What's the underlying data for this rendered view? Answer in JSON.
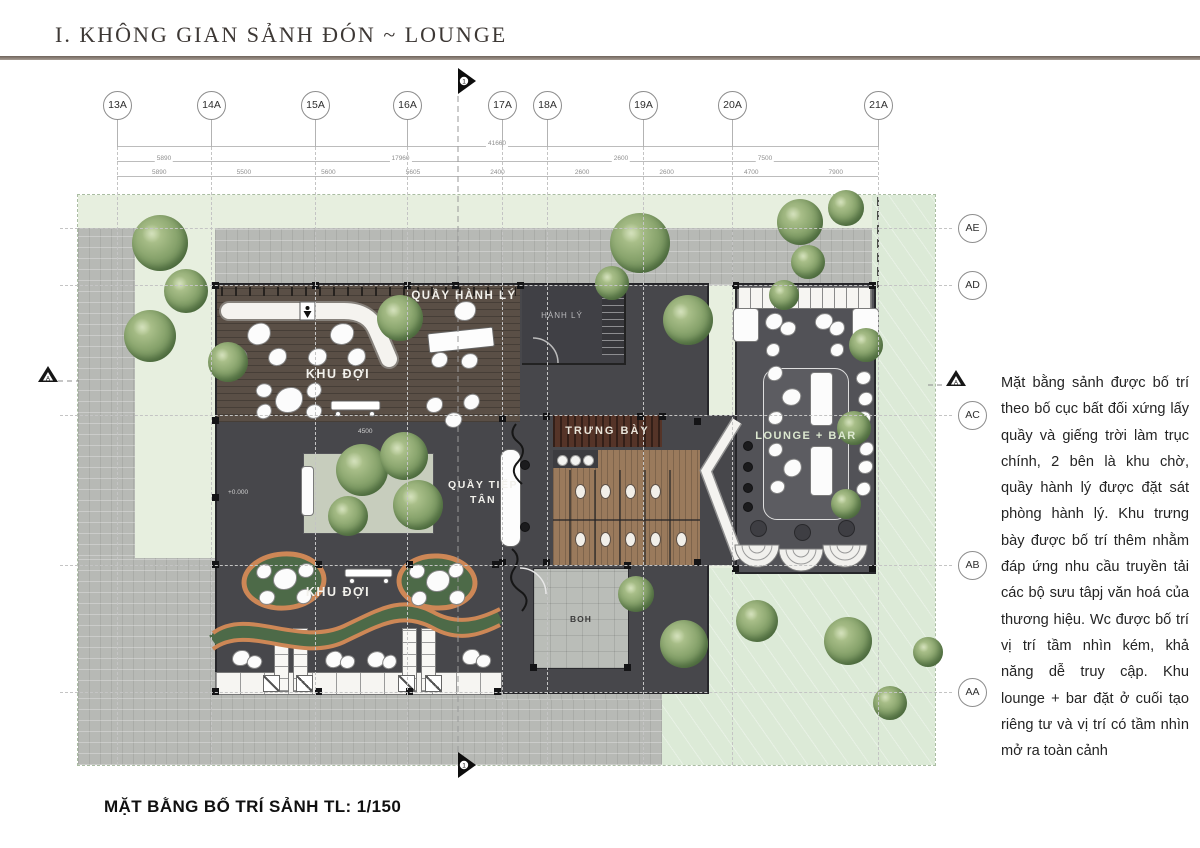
{
  "title": "I. KHÔNG GIAN SẢNH ĐÓN ~ LOUNGE",
  "caption": "MẶT BẰNG BỐ TRÍ SẢNH TL: 1/150",
  "annotation": "Mặt bằng sảnh được bố trí theo bố cục bất đối xứng lấy quầy và giếng trời làm trục chính, 2 bên là khu chờ, quầy hành lý được đặt sát phòng hành lý. Khu trưng bày được bố trí thêm nhằm đáp ứng nhu cầu truyền tải các bộ sưu tâpj văn hoá của thương hiệu. Wc được bố trí vị trí tầm nhìn kém, khả năng dễ truy cập. Khu lounge + bar đặt ở cuối tạo riêng tư và vị trí có tầm nhìn mở ra toàn cảnh",
  "labels": {
    "khu_doi_top": "KHU ĐỢI",
    "quay_hanh_ly": "QUẦY HÀNH LÝ",
    "hanh_ly": "HÀNH LÝ",
    "trung_bay": "TRƯNG BÀY",
    "quay_tiep_tan": "QUẦY TIẾP TÂN",
    "khu_doi_bottom": "KHU ĐỢI",
    "lounge_bar": "LOUNGE + BAR",
    "boh": "BOH"
  },
  "section_marker_label": "1",
  "elevation_marker_label": "A",
  "grid_top": [
    {
      "label": "13A",
      "x": 117
    },
    {
      "label": "14A",
      "x": 211
    },
    {
      "label": "15A",
      "x": 315
    },
    {
      "label": "16A",
      "x": 407
    },
    {
      "label": "17A",
      "x": 502
    },
    {
      "label": "18A",
      "x": 547
    },
    {
      "label": "19A",
      "x": 643
    },
    {
      "label": "20A",
      "x": 732
    },
    {
      "label": "21A",
      "x": 878
    }
  ],
  "grid_right": [
    {
      "label": "AE",
      "y": 228
    },
    {
      "label": "AD",
      "y": 285
    },
    {
      "label": "AC",
      "y": 415
    },
    {
      "label": "AB",
      "y": 565
    },
    {
      "label": "AA",
      "y": 692
    }
  ],
  "dimensions": {
    "total": "41660",
    "tier2": [
      {
        "t": "5890",
        "a": 117,
        "b": 211
      },
      {
        "t": "17960",
        "a": 211,
        "b": 590
      },
      {
        "t": "2600",
        "a": 590,
        "b": 652
      },
      {
        "t": "7500",
        "a": 652,
        "b": 878
      }
    ],
    "tier3": [
      "5890",
      "5500",
      "5600",
      "5605",
      "2400",
      "2600",
      "2600",
      "4700",
      "7900"
    ],
    "planter": "4500",
    "level": "+0.000"
  },
  "colors": {
    "rule": "#9b9089",
    "charcoal": "#47474b",
    "wing": "#525257",
    "wood_dark": "#5a4f46",
    "wood_wc": "#9a7a5c",
    "display_band": "#553428",
    "paving": "#b7b9b5",
    "landscape": "#e7efdf",
    "lawn": "#dcead7",
    "orange": "#cd8756",
    "moss": "#4d6a48",
    "tree": "#7a9763"
  },
  "trees": [
    [
      160,
      243,
      56
    ],
    [
      186,
      291,
      44
    ],
    [
      150,
      336,
      52
    ],
    [
      228,
      362,
      40
    ],
    [
      400,
      318,
      46
    ],
    [
      362,
      470,
      52
    ],
    [
      404,
      456,
      48
    ],
    [
      418,
      505,
      50
    ],
    [
      348,
      516,
      40
    ],
    [
      640,
      243,
      60
    ],
    [
      688,
      320,
      50
    ],
    [
      612,
      283,
      34
    ],
    [
      800,
      222,
      46
    ],
    [
      846,
      208,
      36
    ],
    [
      808,
      262,
      34
    ],
    [
      784,
      295,
      30
    ],
    [
      866,
      345,
      34
    ],
    [
      854,
      428,
      34
    ],
    [
      846,
      504,
      30
    ],
    [
      636,
      594,
      36
    ],
    [
      684,
      644,
      48
    ],
    [
      757,
      621,
      42
    ],
    [
      848,
      641,
      48
    ],
    [
      890,
      703,
      34
    ],
    [
      928,
      652,
      30
    ]
  ],
  "chairs": [
    [
      258,
      333,
      22,
      -8
    ],
    [
      341,
      333,
      22,
      6
    ],
    [
      236,
      356,
      17,
      12
    ],
    [
      276,
      356,
      17,
      -5
    ],
    [
      316,
      356,
      17,
      8
    ],
    [
      355,
      356,
      17,
      -10
    ],
    [
      288,
      399,
      26,
      0
    ],
    [
      263,
      389,
      14,
      20
    ],
    [
      263,
      410,
      14,
      -15
    ],
    [
      313,
      389,
      14,
      -20
    ],
    [
      313,
      410,
      14,
      10
    ],
    [
      433,
      404,
      15,
      0
    ],
    [
      452,
      419,
      15,
      15
    ],
    [
      470,
      401,
      15,
      -12
    ],
    [
      464,
      310,
      20,
      5
    ],
    [
      438,
      359,
      15,
      0
    ],
    [
      468,
      360,
      15,
      8
    ],
    [
      284,
      578,
      22,
      0
    ],
    [
      263,
      570,
      14,
      -10
    ],
    [
      305,
      569,
      14,
      12
    ],
    [
      266,
      596,
      14,
      14
    ],
    [
      303,
      595,
      14,
      -8
    ],
    [
      437,
      580,
      22,
      0
    ],
    [
      416,
      570,
      14,
      10
    ],
    [
      455,
      569,
      14,
      -12
    ],
    [
      418,
      597,
      14,
      -6
    ],
    [
      456,
      596,
      14,
      8
    ],
    [
      240,
      657,
      16,
      0
    ],
    [
      253,
      661,
      13,
      18
    ],
    [
      333,
      658,
      16,
      -8
    ],
    [
      346,
      661,
      13,
      10
    ],
    [
      375,
      658,
      16,
      6
    ],
    [
      388,
      661,
      13,
      -14
    ],
    [
      470,
      656,
      16,
      0
    ],
    [
      482,
      660,
      13,
      12
    ],
    [
      773,
      320,
      16,
      -6
    ],
    [
      787,
      327,
      14,
      10
    ],
    [
      823,
      320,
      16,
      8
    ],
    [
      836,
      327,
      14,
      -8
    ],
    [
      772,
      349,
      12,
      0
    ],
    [
      836,
      349,
      12,
      0
    ],
    [
      774,
      372,
      14,
      -10
    ],
    [
      790,
      396,
      17,
      14
    ],
    [
      774,
      417,
      13,
      6
    ],
    [
      774,
      449,
      13,
      -8
    ],
    [
      791,
      467,
      17,
      -14
    ],
    [
      776,
      486,
      13,
      10
    ],
    [
      862,
      377,
      13,
      8
    ],
    [
      864,
      398,
      13,
      -6
    ],
    [
      862,
      417,
      13,
      10
    ],
    [
      865,
      448,
      13,
      -10
    ],
    [
      864,
      466,
      13,
      6
    ],
    [
      862,
      488,
      13,
      -8
    ]
  ],
  "sofas": [
    [
      733,
      308,
      24,
      32
    ],
    [
      852,
      308,
      25,
      30
    ],
    [
      810,
      372,
      21,
      52
    ],
    [
      810,
      446,
      21,
      48
    ],
    [
      301,
      466,
      11,
      48
    ]
  ],
  "fixtures": [
    [
      579,
      490
    ],
    [
      579,
      538
    ],
    [
      604,
      490
    ],
    [
      604,
      538
    ],
    [
      629,
      490
    ],
    [
      629,
      538
    ],
    [
      654,
      490
    ],
    [
      654,
      538
    ],
    [
      680,
      538
    ]
  ],
  "dots": [
    [
      524,
      464,
      8,
      "#1b1b1d"
    ],
    [
      524,
      526,
      8,
      "#1b1b1d"
    ],
    [
      747,
      445,
      8,
      "#1b1b1d"
    ],
    [
      747,
      466,
      8,
      "#1b1b1d"
    ],
    [
      747,
      487,
      8,
      "#1b1b1d"
    ],
    [
      747,
      506,
      8,
      "#1b1b1d"
    ],
    [
      757,
      527,
      15,
      "#3e3e43"
    ],
    [
      801,
      531,
      15,
      "#3e3e43"
    ],
    [
      845,
      527,
      15,
      "#3e3e43"
    ],
    [
      561,
      459,
      9,
      "#f4f4f2"
    ],
    [
      574,
      459,
      9,
      "#f4f4f2"
    ],
    [
      587,
      459,
      9,
      "#f4f4f2"
    ]
  ],
  "columns": [
    [
      215,
      285
    ],
    [
      315,
      285
    ],
    [
      407,
      285
    ],
    [
      455,
      285
    ],
    [
      520,
      285
    ],
    [
      622,
      285
    ],
    [
      735,
      285
    ],
    [
      872,
      285
    ],
    [
      215,
      420
    ],
    [
      215,
      497
    ],
    [
      215,
      564
    ],
    [
      318,
      564
    ],
    [
      409,
      564
    ],
    [
      495,
      564
    ],
    [
      215,
      691
    ],
    [
      318,
      691
    ],
    [
      409,
      691
    ],
    [
      497,
      691
    ],
    [
      502,
      418
    ],
    [
      546,
      416
    ],
    [
      640,
      416
    ],
    [
      662,
      416
    ],
    [
      502,
      562
    ],
    [
      546,
      562
    ],
    [
      697,
      421
    ],
    [
      697,
      562
    ],
    [
      735,
      568
    ],
    [
      872,
      568
    ],
    [
      627,
      565
    ],
    [
      627,
      667
    ],
    [
      533,
      667
    ]
  ]
}
